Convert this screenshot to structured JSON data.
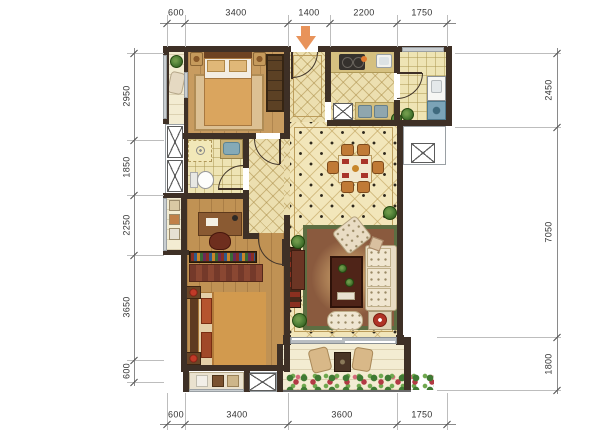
{
  "plan": {
    "dims_top": [
      "600",
      "3400",
      "1400",
      "2200",
      "1750"
    ],
    "dims_bottom": [
      "600",
      "3400",
      "3600",
      "1750"
    ],
    "dims_left": [
      "2950",
      "1850",
      "2250",
      "3650",
      "600"
    ],
    "dims_right": [
      "2450",
      "7050",
      "1800"
    ],
    "entrance": {
      "arrow_color": "#e8935a"
    },
    "colors": {
      "wall": "#3e3026",
      "wood_floor": "#c89c60",
      "tile_floor": "#f2e6ba",
      "water_fixture_blue": "#85aab7",
      "rug_red_brown": "#8a5a3e",
      "sofa_cream": "#e9dcc4",
      "dining_chair_orange": "#c07a36",
      "plant_green": "#4a7a33",
      "flower_red": "#b23a44"
    }
  }
}
